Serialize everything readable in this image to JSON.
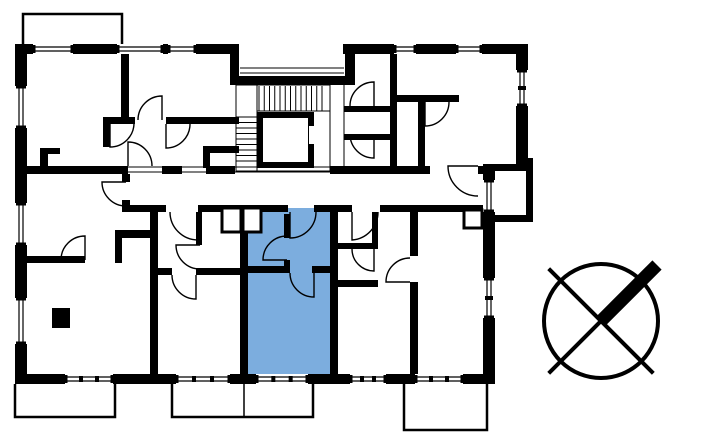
{
  "meta": {
    "description": "architectural-floorplan-with-highlighted-unit",
    "background_color": "#ffffff",
    "wall_color": "#000000",
    "highlight_color": "#7CADDE",
    "canvas": {
      "width": 722,
      "height": 440
    }
  },
  "floorplan": {
    "highlighted_unit": {
      "x": 244,
      "y": 208,
      "w": 88,
      "h": 166
    },
    "walls": [
      [
        15,
        44,
        224,
        10
      ],
      [
        343,
        44,
        185,
        10
      ],
      [
        230,
        44,
        9,
        41
      ],
      [
        345,
        44,
        10,
        41
      ],
      [
        230,
        76,
        125,
        9
      ],
      [
        15,
        44,
        12,
        340
      ],
      [
        516,
        44,
        12,
        120
      ],
      [
        516,
        158,
        17,
        12
      ],
      [
        488,
        164,
        45,
        7
      ],
      [
        526,
        164,
        7,
        58
      ],
      [
        488,
        215,
        45,
        7
      ],
      [
        483,
        164,
        12,
        16
      ],
      [
        483,
        212,
        12,
        172
      ],
      [
        15,
        374,
        480,
        10
      ],
      [
        121,
        54,
        8,
        63
      ],
      [
        103,
        117,
        32,
        7
      ],
      [
        103,
        117,
        7,
        30
      ],
      [
        166,
        117,
        73,
        7
      ],
      [
        203,
        146,
        36,
        7
      ],
      [
        203,
        146,
        7,
        22
      ],
      [
        40,
        148,
        8,
        18
      ],
      [
        40,
        148,
        20,
        6
      ],
      [
        15,
        166,
        113,
        8
      ],
      [
        162,
        166,
        20,
        8
      ],
      [
        206,
        166,
        29,
        8
      ],
      [
        330,
        166,
        100,
        8
      ],
      [
        478,
        166,
        5,
        8
      ],
      [
        122,
        174,
        8,
        8
      ],
      [
        122,
        200,
        8,
        6
      ],
      [
        122,
        205,
        28,
        7
      ],
      [
        158,
        205,
        8,
        7
      ],
      [
        198,
        205,
        90,
        7
      ],
      [
        314,
        205,
        38,
        7
      ],
      [
        380,
        205,
        103,
        7
      ],
      [
        150,
        205,
        8,
        169
      ],
      [
        240,
        205,
        8,
        169
      ],
      [
        330,
        205,
        8,
        169
      ],
      [
        410,
        205,
        8,
        169
      ],
      [
        15,
        256,
        70,
        7
      ],
      [
        115,
        230,
        35,
        8
      ],
      [
        115,
        230,
        7,
        33
      ],
      [
        52,
        308,
        18,
        20
      ],
      [
        196,
        212,
        6,
        33
      ],
      [
        158,
        268,
        14,
        7
      ],
      [
        196,
        268,
        44,
        7
      ],
      [
        284,
        214,
        6,
        24
      ],
      [
        284,
        260,
        6,
        12
      ],
      [
        244,
        266,
        46,
        7
      ],
      [
        312,
        266,
        20,
        7
      ],
      [
        372,
        212,
        6,
        37
      ],
      [
        338,
        243,
        40,
        6
      ],
      [
        338,
        280,
        40,
        7
      ],
      [
        390,
        54,
        7,
        112
      ],
      [
        344,
        106,
        50,
        6
      ],
      [
        344,
        134,
        50,
        6
      ],
      [
        397,
        95,
        62,
        7
      ],
      [
        418,
        102,
        7,
        64
      ]
    ],
    "wall_gaps": [
      [
        410,
        256,
        8,
        26
      ]
    ],
    "windows": [
      {
        "x": 33,
        "y": 44,
        "w": 40,
        "h": 10,
        "o": "h",
        "ticks": 0
      },
      {
        "x": 117,
        "y": 44,
        "w": 46,
        "h": 10,
        "o": "h",
        "ticks": 0
      },
      {
        "x": 168,
        "y": 44,
        "w": 28,
        "h": 10,
        "o": "h",
        "ticks": 0
      },
      {
        "x": 394,
        "y": 44,
        "w": 22,
        "h": 10,
        "o": "h",
        "ticks": 0
      },
      {
        "x": 456,
        "y": 44,
        "w": 26,
        "h": 10,
        "o": "h",
        "ticks": 0
      },
      {
        "x": 65,
        "y": 374,
        "w": 48,
        "h": 10,
        "o": "h",
        "ticks": 2
      },
      {
        "x": 176,
        "y": 374,
        "w": 54,
        "h": 10,
        "o": "h",
        "ticks": 2
      },
      {
        "x": 256,
        "y": 374,
        "w": 52,
        "h": 10,
        "o": "h",
        "ticks": 2
      },
      {
        "x": 350,
        "y": 374,
        "w": 36,
        "h": 10,
        "o": "h",
        "ticks": 2
      },
      {
        "x": 415,
        "y": 374,
        "w": 48,
        "h": 10,
        "o": "h",
        "ticks": 2
      },
      {
        "x": 15,
        "y": 86,
        "w": 12,
        "h": 42,
        "o": "v",
        "ticks": 0
      },
      {
        "x": 15,
        "y": 203,
        "w": 12,
        "h": 42,
        "o": "v",
        "ticks": 0
      },
      {
        "x": 15,
        "y": 298,
        "w": 12,
        "h": 46,
        "o": "v",
        "ticks": 0
      },
      {
        "x": 516,
        "y": 70,
        "w": 12,
        "h": 36,
        "o": "v",
        "ticks": 1
      },
      {
        "x": 483,
        "y": 180,
        "w": 12,
        "h": 32,
        "o": "v",
        "ticks": 0
      },
      {
        "x": 483,
        "y": 278,
        "w": 12,
        "h": 40,
        "o": "v",
        "ticks": 1
      }
    ],
    "balconies": [
      {
        "x": 23,
        "y": 14,
        "w": 99,
        "h": 34,
        "open": "bottom",
        "divider_x": null
      },
      {
        "x": 15,
        "y": 384,
        "w": 100,
        "h": 33,
        "open": "top",
        "divider_x": null
      },
      {
        "x": 172,
        "y": 384,
        "w": 141,
        "h": 33,
        "open": "top",
        "divider_x": 244
      },
      {
        "x": 404,
        "y": 384,
        "w": 83,
        "h": 46,
        "open": "top",
        "divider_x": null
      }
    ],
    "thresholds": [
      {
        "x": 128,
        "y": 167,
        "len": 34,
        "o": "h"
      },
      {
        "x": 182,
        "y": 167,
        "len": 24,
        "o": "h"
      },
      {
        "x": 235,
        "y": 167,
        "len": 95,
        "o": "h"
      },
      {
        "x": 240,
        "y": 68,
        "len": 104,
        "o": "h"
      }
    ],
    "stairs": {
      "outline": [
        236,
        85,
        94,
        86
      ],
      "v_treads": {
        "x1": 259,
        "x2": 322,
        "step": 5.25,
        "y1": 86,
        "y2": 111
      },
      "h_treads": {
        "y1": 117,
        "y2": 166,
        "step": 5.5,
        "x1": 236,
        "x2": 257
      },
      "lines": [
        [
          257,
          85,
          257,
          171
        ],
        [
          257,
          111,
          330,
          111
        ],
        [
          330,
          85,
          330,
          171
        ],
        [
          236,
          171,
          330,
          171
        ],
        [
          344,
          84,
          344,
          166
        ]
      ]
    },
    "elevator": {
      "frame": [
        257,
        112,
        57,
        56
      ],
      "cab": [
        263,
        118,
        45,
        44
      ],
      "door": [
        309,
        126,
        5,
        18
      ]
    },
    "vent_shafts": [
      [
        222,
        208,
        19,
        24
      ],
      [
        243,
        208,
        18,
        24
      ],
      [
        464,
        210,
        18,
        18
      ]
    ],
    "doors": [
      {
        "h": [
          162,
          120
        ],
        "l": [
          162,
          96
        ],
        "a": [
          138,
          120
        ]
      },
      {
        "h": [
          110,
          123
        ],
        "l": [
          110,
          147
        ],
        "a": [
          134,
          123
        ]
      },
      {
        "h": [
          166,
          124
        ],
        "l": [
          166,
          148
        ],
        "a": [
          190,
          124
        ]
      },
      {
        "h": [
          128,
          166
        ],
        "l": [
          128,
          142
        ],
        "a": [
          152,
          166
        ]
      },
      {
        "h": [
          126,
          182
        ],
        "l": [
          102,
          182
        ],
        "a": [
          126,
          206
        ]
      },
      {
        "h": [
          85,
          260
        ],
        "l": [
          85,
          236
        ],
        "a": [
          61,
          260
        ]
      },
      {
        "h": [
          198,
          212
        ],
        "l": [
          198,
          240
        ],
        "a": [
          170,
          212
        ]
      },
      {
        "h": [
          200,
          245
        ],
        "l": [
          176,
          245
        ],
        "a": [
          200,
          269
        ]
      },
      {
        "h": [
          196,
          275
        ],
        "l": [
          196,
          299
        ],
        "a": [
          172,
          275
        ]
      },
      {
        "h": [
          290,
          212
        ],
        "l": [
          290,
          238
        ],
        "a": [
          316,
          212
        ]
      },
      {
        "h": [
          287,
          260
        ],
        "l": [
          263,
          260
        ],
        "a": [
          287,
          236
        ]
      },
      {
        "h": [
          314,
          273
        ],
        "l": [
          314,
          297
        ],
        "a": [
          290,
          273
        ]
      },
      {
        "h": [
          352,
          212
        ],
        "l": [
          352,
          240
        ],
        "a": [
          378,
          212
        ]
      },
      {
        "h": [
          374,
          249
        ],
        "l": [
          374,
          271
        ],
        "a": [
          352,
          249
        ]
      },
      {
        "h": [
          410,
          282
        ],
        "l": [
          386,
          282
        ],
        "a": [
          410,
          258
        ]
      },
      {
        "h": [
          374,
          106
        ],
        "l": [
          374,
          82
        ],
        "a": [
          350,
          106
        ]
      },
      {
        "h": [
          374,
          134
        ],
        "l": [
          374,
          158
        ],
        "a": [
          350,
          134
        ]
      },
      {
        "h": [
          425,
          102
        ],
        "l": [
          425,
          126
        ],
        "a": [
          449,
          102
        ]
      },
      {
        "h": [
          478,
          166
        ],
        "l": [
          448,
          166
        ],
        "a": [
          478,
          196
        ]
      }
    ],
    "compass": {
      "cx": 601,
      "cy": 321,
      "r": 57,
      "stroke": 4,
      "arm_end": [
        657,
        265
      ],
      "arm_width": 13
    }
  }
}
